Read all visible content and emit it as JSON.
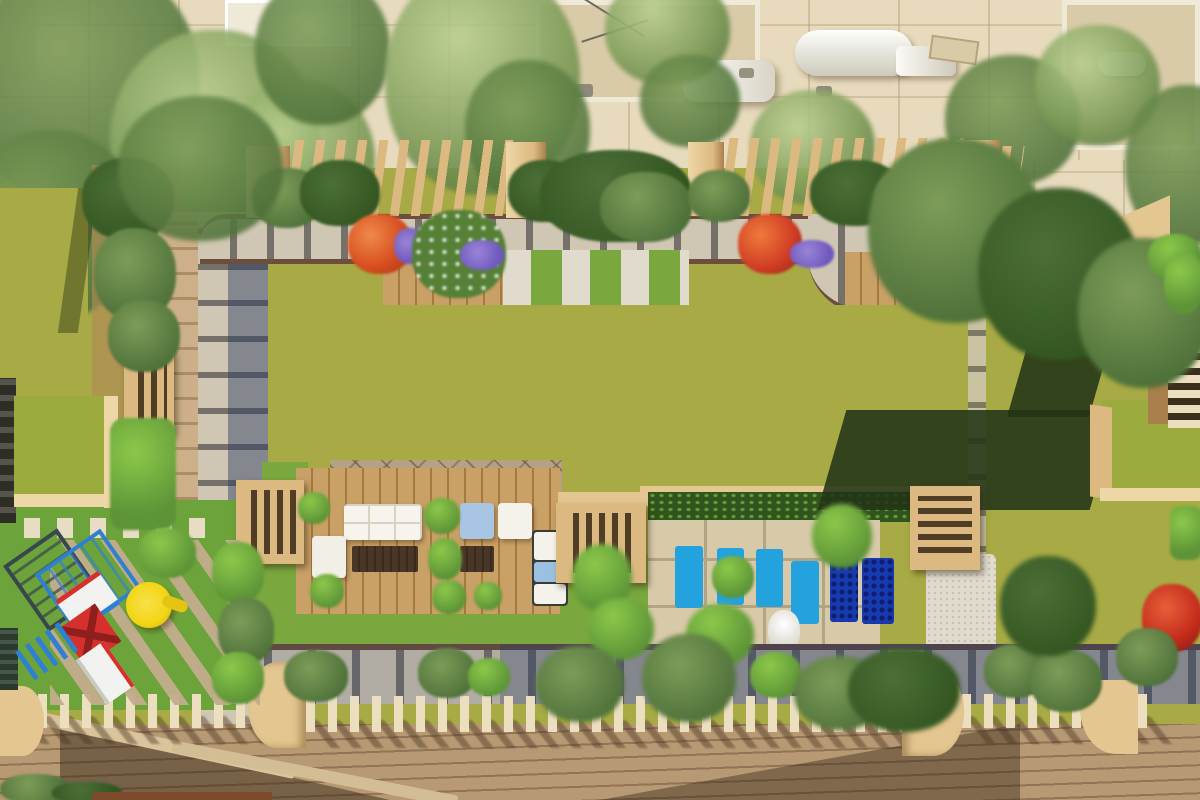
{
  "meta": {
    "title": "Aerial top-down 3D render of a residential rooftop amenity garden",
    "view": "top-down aerial",
    "time_of_day": "daytime, strong sun from upper-right casting long shadows"
  },
  "palette": {
    "street": "#e7dabd",
    "roofBeige": "#d9cba8",
    "roofEdge": "#efe9d8",
    "whitePure": "#f4f2ea",
    "treeHi": "#b9cf8e",
    "treeMid": "#7d9c58",
    "treeLo": "#4c6f38",
    "treeDeep": "#32551f",
    "bushBright": "#8cc84a",
    "bushMid": "#5d9437",
    "hedge": "#2f541d",
    "pergTan": "#dcb980",
    "pergHi": "#eed7a6",
    "pergDark": "#a97f4c",
    "finCream": "#ecdfc0",
    "pavL": "#cfc7b3",
    "pavJ": "#75716a",
    "edgeBrown": "#6d4e3d",
    "woodPath": "#cdb089",
    "deckWood": "#c9a065",
    "deckLine": "#a5793f",
    "mosaic": "#b7a183",
    "botDeck": "#b79a74",
    "botDeckLine": "#937355",
    "lawnOlive": "#a8ab45",
    "lawnBright": "#7aa83e",
    "lawnBright2": "#6da33b",
    "turfTop": "#9cab3e",
    "lawnShadow": "#23401a",
    "stone": "#d8caa9",
    "stoneJoint": "#b3a482",
    "gravel": "#e1dbcd",
    "poolBlue": "#23a2de",
    "poolDeep": "#1839b0",
    "flOrange": "#d84f20",
    "flPurple": "#6f58bd",
    "flWhite": "#ffffff",
    "flYellow": "#d8c33e",
    "playBlue": "#2f80d0",
    "playRed": "#d5302c",
    "playYellow": "#f3d513",
    "playWhite": "#f2f2f0",
    "playFrame": "#37474c",
    "tanWall": "#e4c690"
  },
  "scene": {
    "street_level": [
      "paved street with joint grid",
      "white delivery van",
      "white box truck",
      "building rooftops with parapets",
      "rooftop water tanks",
      "satellite dish",
      "dense street trees"
    ],
    "rooftop_garden": [
      "slatted pergola band with tan pillars",
      "flower planters (orange, purple, white blooms)",
      "paver walkways with dark joint strips",
      "gravel and grass stepping strips",
      "large central olive lawn",
      "timber lounge deck with white and blue cushioned sofas",
      "tan louvered pergola boxes",
      "clipped hedge",
      "stone sun patio with four bright-blue loungers and two shaded loungers",
      "white parasol figure",
      "gravel bed",
      "green-roofed utility cubes with long cast shadows",
      "children playground with blue climber, red-and-yellow tower and white slide",
      "cream pergola fin rows over lower walkway",
      "curved tan parapet walls",
      "wide diagonal timber sun deck"
    ]
  }
}
